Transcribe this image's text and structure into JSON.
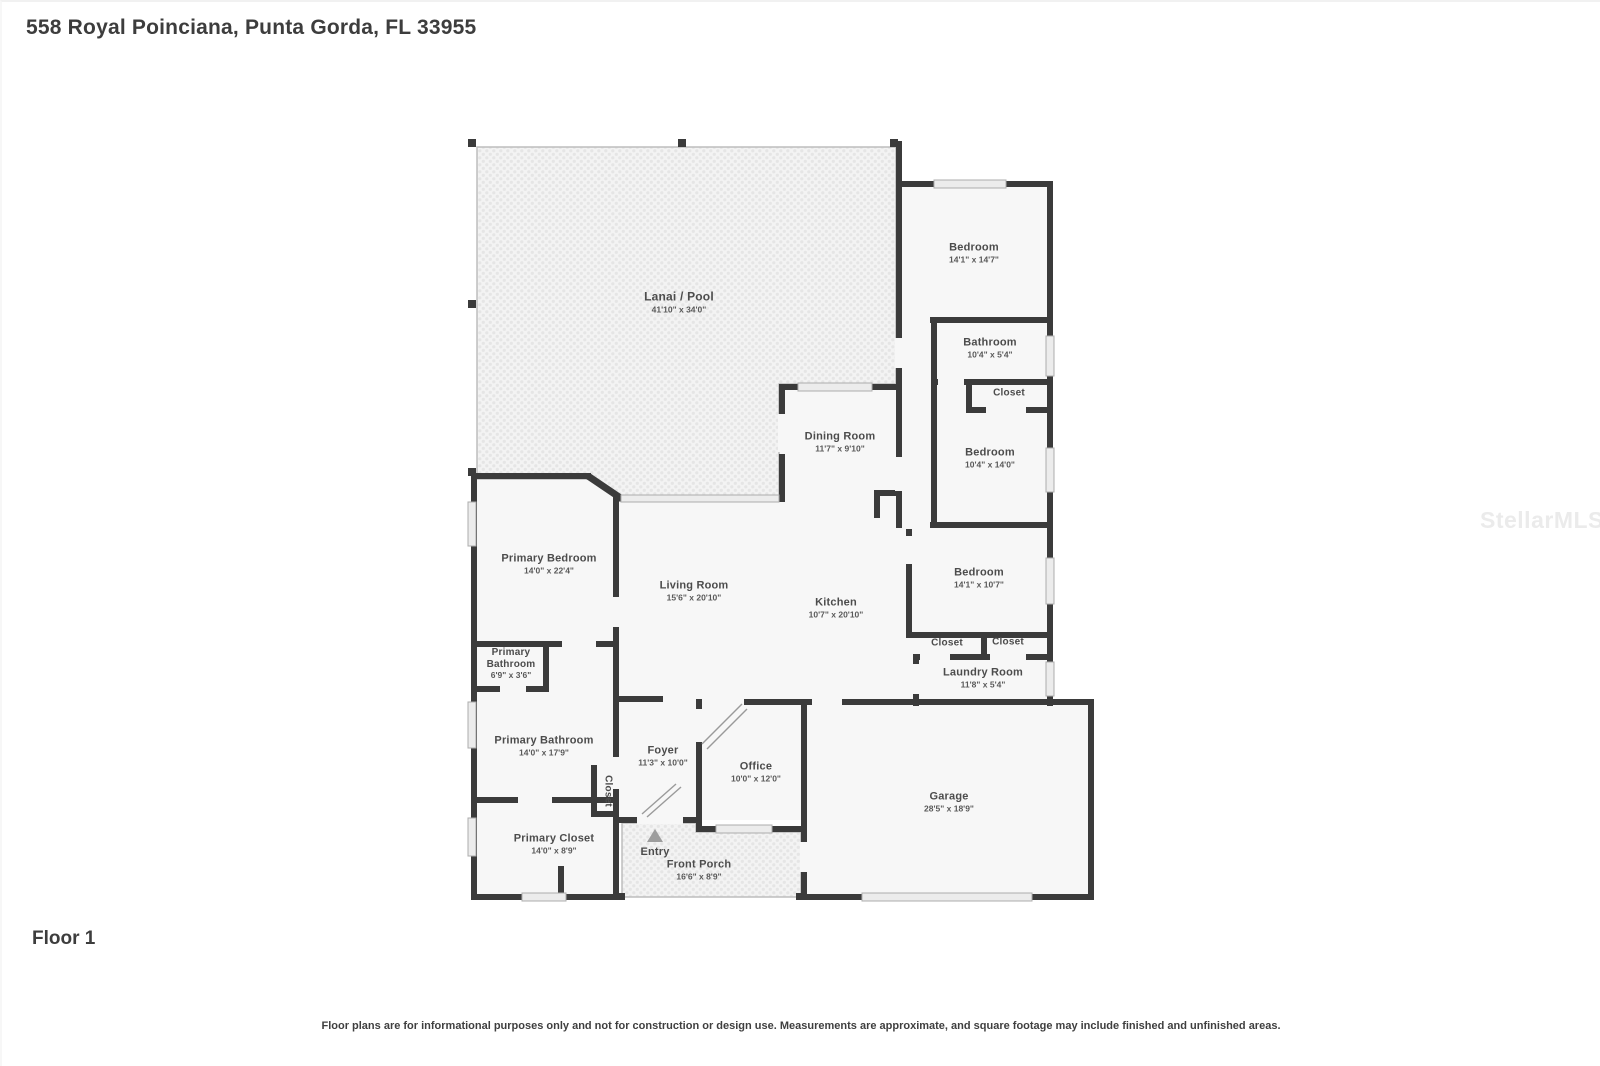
{
  "page": {
    "title": "558 Royal Poinciana, Punta Gorda, FL 33955",
    "floor_label": "Floor 1",
    "disclaimer": "Floor plans are for informational purposes only and not for construction or design use. Measurements are approximate, and square footage may include finished and unfinished areas.",
    "watermark": "StellarMLS"
  },
  "colors": {
    "wall": "#3b3b3b",
    "room_fill": "#f7f7f7",
    "hatch_base": "#f3f3f3",
    "hatch_dot": "#e5e5e5",
    "window_fill": "#ececec",
    "label_text": "#4c4c4c"
  },
  "rooms": [
    {
      "id": "lanai-pool",
      "name": "Lanai / Pool",
      "dims": "41'10\" x 34'0\""
    },
    {
      "id": "bedroom-top",
      "name": "Bedroom",
      "dims": "14'1\" x 14'7\""
    },
    {
      "id": "bathroom",
      "name": "Bathroom",
      "dims": "10'4\" x 5'4\""
    },
    {
      "id": "closet-bathroom",
      "name": "Closet",
      "dims": ""
    },
    {
      "id": "bedroom-middle",
      "name": "Bedroom",
      "dims": "10'4\" x 14'0\""
    },
    {
      "id": "dining-room",
      "name": "Dining Room",
      "dims": "11'7\" x 9'10\""
    },
    {
      "id": "primary-bedroom",
      "name": "Primary Bedroom",
      "dims": "14'0\" x 22'4\""
    },
    {
      "id": "living-room",
      "name": "Living Room",
      "dims": "15'6\" x 20'10\""
    },
    {
      "id": "kitchen",
      "name": "Kitchen",
      "dims": "10'7\" x 20'10\""
    },
    {
      "id": "bedroom-right",
      "name": "Bedroom",
      "dims": "14'1\" x 10'7\""
    },
    {
      "id": "closet-hall-left",
      "name": "Closet",
      "dims": ""
    },
    {
      "id": "closet-hall-right",
      "name": "Closet",
      "dims": ""
    },
    {
      "id": "laundry-room",
      "name": "Laundry Room",
      "dims": "11'8\" x 5'4\""
    },
    {
      "id": "primary-bathroom-small",
      "name": "Primary Bathroom",
      "dims": "6'9\" x 3'6\""
    },
    {
      "id": "primary-bathroom",
      "name": "Primary Bathroom",
      "dims": "14'0\" x 17'9\""
    },
    {
      "id": "foyer",
      "name": "Foyer",
      "dims": "11'3\" x 10'0\""
    },
    {
      "id": "office",
      "name": "Office",
      "dims": "10'0\" x 12'0\""
    },
    {
      "id": "garage",
      "name": "Garage",
      "dims": "28'5\" x 18'9\""
    },
    {
      "id": "closet-foyer",
      "name": "Closet",
      "dims": ""
    },
    {
      "id": "primary-closet",
      "name": "Primary Closet",
      "dims": "14'0\" x 8'9\""
    },
    {
      "id": "entry",
      "name": "Entry",
      "dims": ""
    },
    {
      "id": "front-porch",
      "name": "Front Porch",
      "dims": "16'6\" x 8'9\""
    }
  ]
}
